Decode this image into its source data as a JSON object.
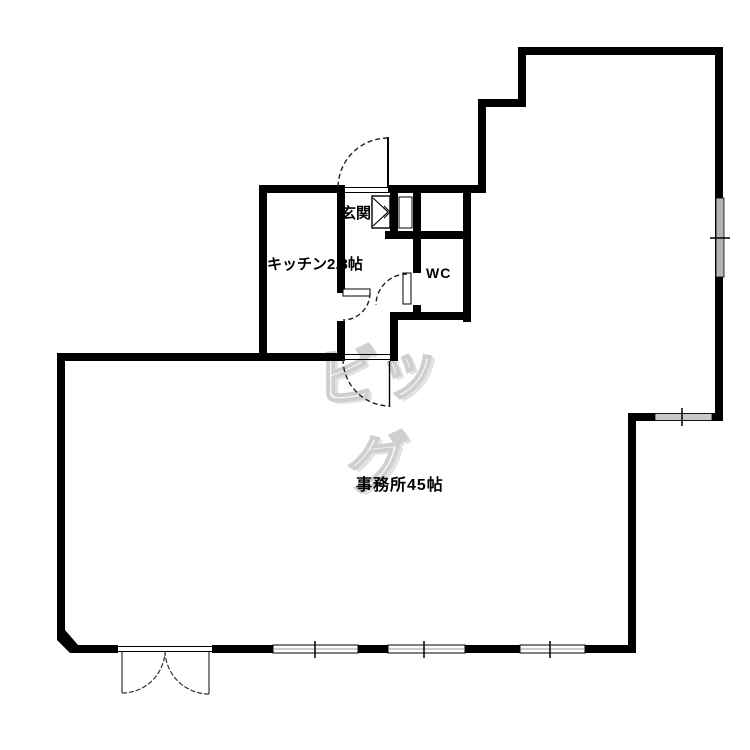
{
  "plan": {
    "type": "floor-plan"
  },
  "rooms": {
    "genkan": {
      "label": "玄関"
    },
    "kitchen": {
      "label": "キッチン2.3帖"
    },
    "wc": {
      "label": "WC"
    },
    "office": {
      "label": "事務所45帖"
    }
  },
  "watermark": {
    "text": "ビッグ"
  },
  "colors": {
    "wall": "#000000",
    "window_glass_side": "#b3b3b3",
    "window_glass_bottom": "#c9c9c9",
    "watermark_outline": "#cfcfcf"
  }
}
